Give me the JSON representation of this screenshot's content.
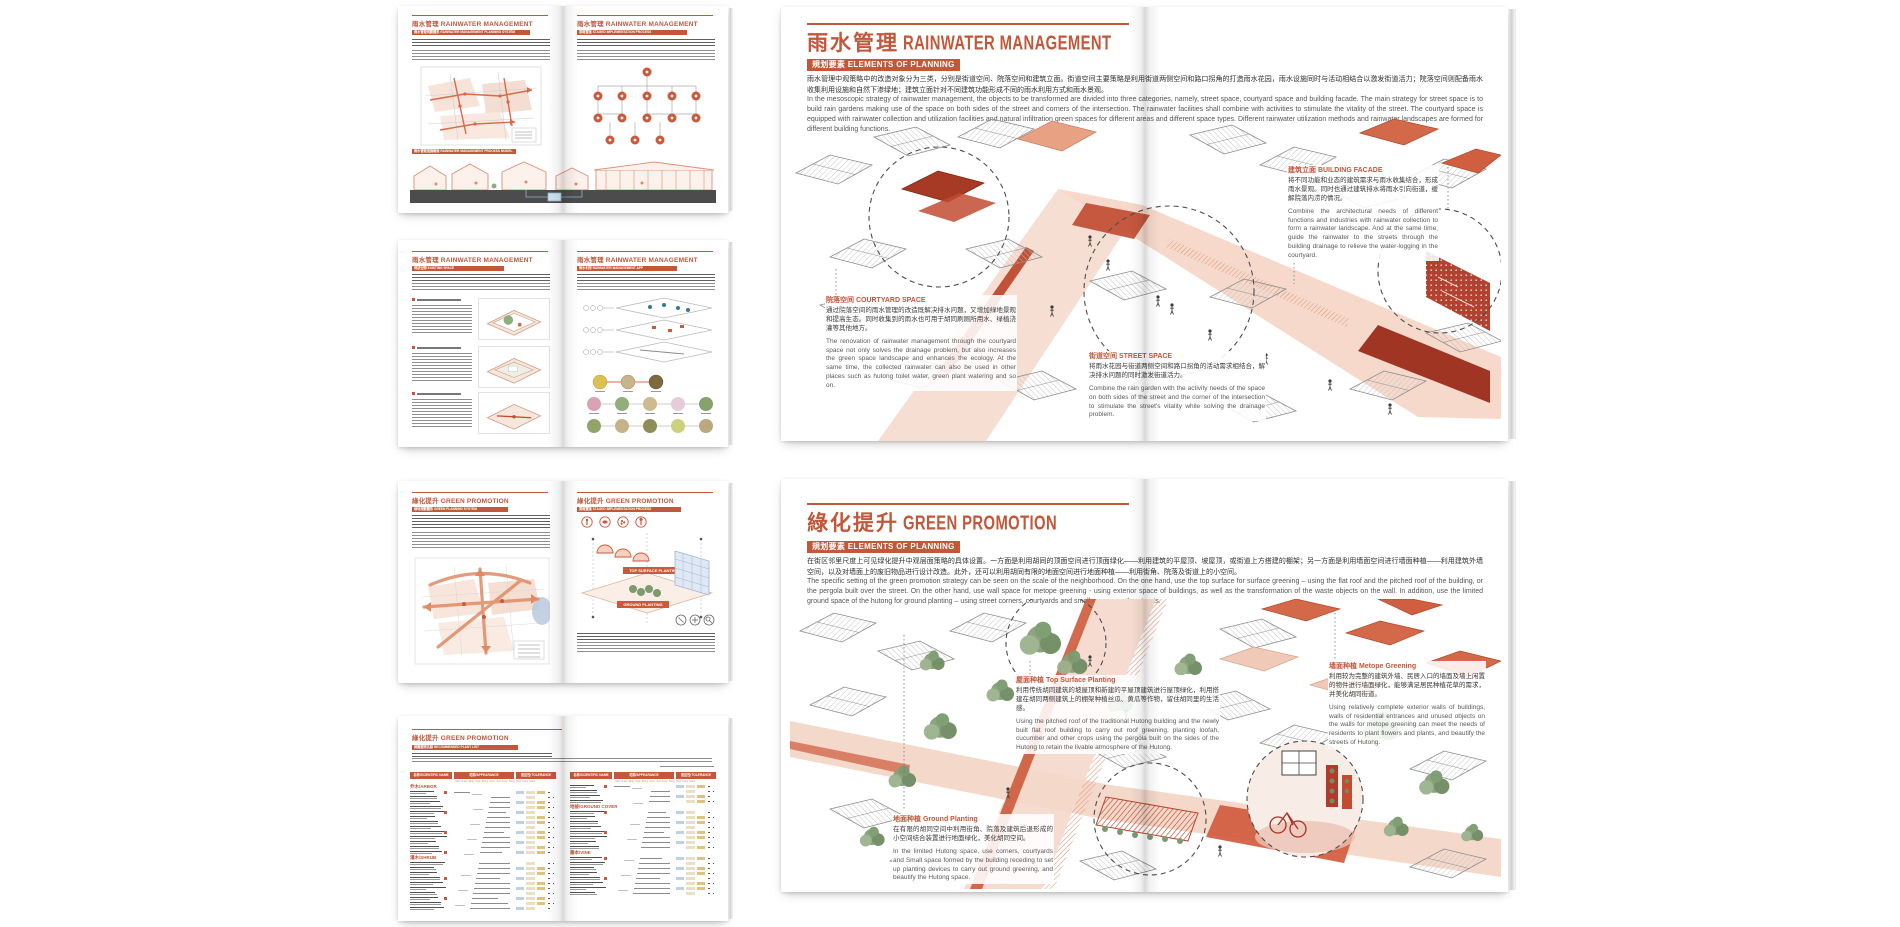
{
  "accent": "#c2573a",
  "palette": {
    "red_accent": "#b03a26",
    "pale_street": "#f6dcd0",
    "roof_hatch_grey": "#c2c2c2",
    "tree_green": "#7d9a6e",
    "wall_blue": "#dfe8f3",
    "ground_dark_grey": "#4c4c4c"
  },
  "rainwater": {
    "title_zh": "雨水管理",
    "title_en": "RAINWATER MANAGEMENT",
    "section_tag": "規划要素 ELEMENTS OF PLANNING",
    "intro_zh": "雨水管理中观策略中的改造对象分为三类，分别是街道空间、院落空间和建筑立面。街道空间主要策略是利用街道两侧空间和路口拐角的打造雨水花园，雨水设施同时与活动相结合以激发街道活力；院落空间则配备雨水收集利用设施和自然下渗绿地；建筑立面针对不同建筑功能形成不同的雨水利用方式和雨水景观。",
    "intro_en": "In the mesoscopic strategy of rainwater management, the objects to be transformed are divided into three categories, namely, street space, courtyard space and building facade. The main strategy for street space is to build rain gardens making use of the space on both sides of the street and corners of the intersection. The rainwater facilities shall combine with activities to stimulate the vitality of the street. The courtyard space is equipped with rainwater collection and utilization facilities and natural infiltration green spaces for different areas and different space types. Different rainwater utilization methods and rainwater landscapes are formed for different building functions.",
    "annotations": {
      "facade": {
        "heading": "建筑立面 BUILDING FACADE",
        "zh": "将不同功能和业态的建筑需求与雨水收集结合，形成雨水景观。同时也通过建筑排水将雨水引向街道，缓解院落内涝的情况。",
        "en": "Combine the architectural needs of different functions and industries with rainwater collection to form a rainwater landscape. And at the same time, guide the rainwater to the streets through the building drainage to relieve the water-logging in the courtyard."
      },
      "courtyard": {
        "heading": "院落空间 COURTYARD SPACE",
        "zh": "通过院落空间的雨水管理的改造既解决排水问题，又增加绿地景观和提高生态。同时收集到的雨水也可用于胡同刷厕所用水、绿植浇灌等其他地方。",
        "en": "The renovation of rainwater management through the courtyard space not only solves the drainage problem, but also increases the green space landscape and enhances the ecology. At the same time, the collected rainwater can also be used in other places such as hutong toilet water, green plant watering and so on."
      },
      "street": {
        "heading": "街道空间 STREET SPACE",
        "zh": "将雨水花园与街道两侧空间和路口拐角的活动需求相结合，解决排水问题的同时激发街道活力。",
        "en": "Combine the rain garden with the activity needs of the space on both sides of the street and the corner of the intersection to stimulate the street's vitality while solving the drainage problem."
      }
    }
  },
  "green": {
    "title_zh": "綠化提升",
    "title_en": "GREEN PROMOTION",
    "section_tag": "規划要素 ELEMENTS OF PLANNING",
    "intro_zh": "在街区邻里尺度上可见绿化提升中观层面策略的具体设置。一方面是利用胡同的顶面空间进行顶面绿化——利用建筑的平屋顶、坡屋顶，或街道上方搭建的棚架；另一方面是利用墙面空间进行墙面种植——利用建筑外墙空间，以及对墙面上的废旧物品进行设计改造。此外，还可以利用胡同有限的地面空间进行地面种植——利用街角、院落及街道上的小空间。",
    "intro_en": "The specific setting of the green promotion strategy can be seen on the scale of the neighborhood. On the one hand, use the top surface for surface greening – using the flat roof and the pitched roof of the building, or the pergola built over the street. On the other hand, use wall space for metope greening - using exterior space of buildings, as well as the transformation of the waste objects on the wall. In addition, use the limited ground space of the hutong for ground planting – using street corners, courtyards and small spaces on the streets.",
    "annotations": {
      "top_surface": {
        "heading": "屋面种植 Top Surface Planting",
        "zh": "利用传统胡同建筑的坡屋顶和新建的平屋顶建筑进行屋顶绿化，利用搭建在胡同两侧建筑上的棚架种植丝瓜、黄瓜等作物，留住胡同里的生活感。",
        "en": "Using the pitched roof of the traditional Hutong building and the newly built flat roof building to carry out roof greening, planting loofah, cucumber and other crops using the pergola built on the sides of the Hutong to retain the livable atmosphere of the Hutong."
      },
      "metope": {
        "heading": "墙面种植 Metope Greening",
        "zh": "利用较为完整的建筑外墙、民居入口的墙面及墙上闲置的物件进行墙面绿化，能够满足居民种植花草的需求，并美化胡同街道。",
        "en": "Using relatively complete exterior walls of buildings, walls of residential entrances and unused objects on the walls for metope greening can meet the needs of residents to plant flowers and plants, and beautify the streets of Hutong."
      },
      "ground": {
        "heading": "地面种植 Ground Planting",
        "zh": "在有限的胡同空间中利用街角、院落及建筑后退形成的小空间结合装置进行地面绿化，美化胡同空间。",
        "en": "In the limited Hutong space, use corners, courtyards and Small space formed by the building receding to set up planting devices to carry out ground greening, and beautify the Hutong space."
      }
    }
  },
  "thumbnails": {
    "t1": {
      "left_title": "雨水管理 RAINWATER MANAGEMENT",
      "right_title": "雨水管理 RAINWATER MANAGEMENT",
      "left_tag": "雨水管理規劃體系 RAINWATER MANAGEMENT PLANNING SYSTEM",
      "right_tag": "策略實施 STAGED IMPLEMENTATION PROCESS",
      "bottom_tag": "雨水管理措施斷面 RAINWATER MANAGEMENT PROCESS MODEL"
    },
    "t2": {
      "left_title": "雨水管理 RAINWATER MANAGEMENT",
      "right_title": "雨水管理 RAINWATER MANAGEMENT",
      "left_tag": "現狀空間 EXISTING SPACE",
      "right_tag": "雨水利用 RAINWATER MANAGEMENT APP"
    },
    "t3": {
      "left_title": "綠化提升 GREEN PROMOTION",
      "right_title": "綠化提升 GREEN PROMOTION",
      "left_tag": "綠地規劃體系 GREEN PLANNING SYSTEM",
      "right_tag": "策略實施 STAGED IMPLEMENTATION PROCESS",
      "label_top": "TOP SURFACE PLANTING",
      "label_ground": "GROUND PLANTING"
    },
    "t4": {
      "title": "綠化提升 GREEN PROMOTION",
      "tag": "推薦植物名錄 RECOMMENDED PLANT LIST",
      "table": {
        "headers": [
          "名称/SCIENTIFIC NAME",
          "花期/APPEARANCE",
          "适应性/TOLERANCE"
        ],
        "months": "Jan Feb Mar Apr May Jun Jul Aug Sep Oct Nov Dec",
        "left_groups": [
          {
            "label": "乔木/ARBOR",
            "rows": 13
          },
          {
            "label": "灌木/SHRUB",
            "rows": 10
          }
        ],
        "right_groups": [
          {
            "label": "",
            "rows": 4
          },
          {
            "label": "地被/GROUND COVER",
            "rows": 8
          },
          {
            "label": "藤本/VINE",
            "rows": 8
          }
        ]
      }
    }
  }
}
